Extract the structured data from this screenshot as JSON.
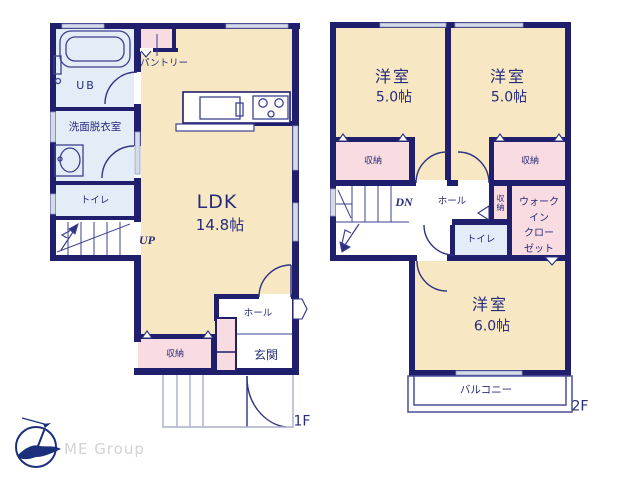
{
  "palette": {
    "wall_navy": "#1f1f6e",
    "room_tan": "#f7e7c3",
    "closet_pink": "#f8dce1",
    "wet_area_blue": "#e3edf8",
    "window_gray": "#d6dbe9",
    "text_navy": "#272b7b",
    "logo_navy": "#1c2f7c",
    "logo_gray": "#d3d3d3"
  },
  "floor1": {
    "name": "1F",
    "ub": "UB",
    "washroom": "洗面脱衣室",
    "toilet": "トイレ",
    "pantry": "パントリー",
    "up": "UP",
    "ldk": "LDK",
    "ldk_size": "14.8帖",
    "storage": "収納",
    "hall": "ホール",
    "entrance": "玄関"
  },
  "floor2": {
    "name": "2F",
    "room_a": "洋室",
    "room_a_size": "5.0帖",
    "room_b": "洋室",
    "room_b_size": "5.0帖",
    "room_c": "洋室",
    "room_c_size": "6.0帖",
    "storage_a": "収納",
    "storage_b": "収納",
    "storage_c": "収納",
    "dn": "DN",
    "hall": "ホール",
    "toilet": "トイレ",
    "walk_in_closet": "ウォーク\nイン\nクロー\nゼット",
    "balcony": "バルコニー"
  },
  "logo": {
    "company": "ME Group"
  }
}
